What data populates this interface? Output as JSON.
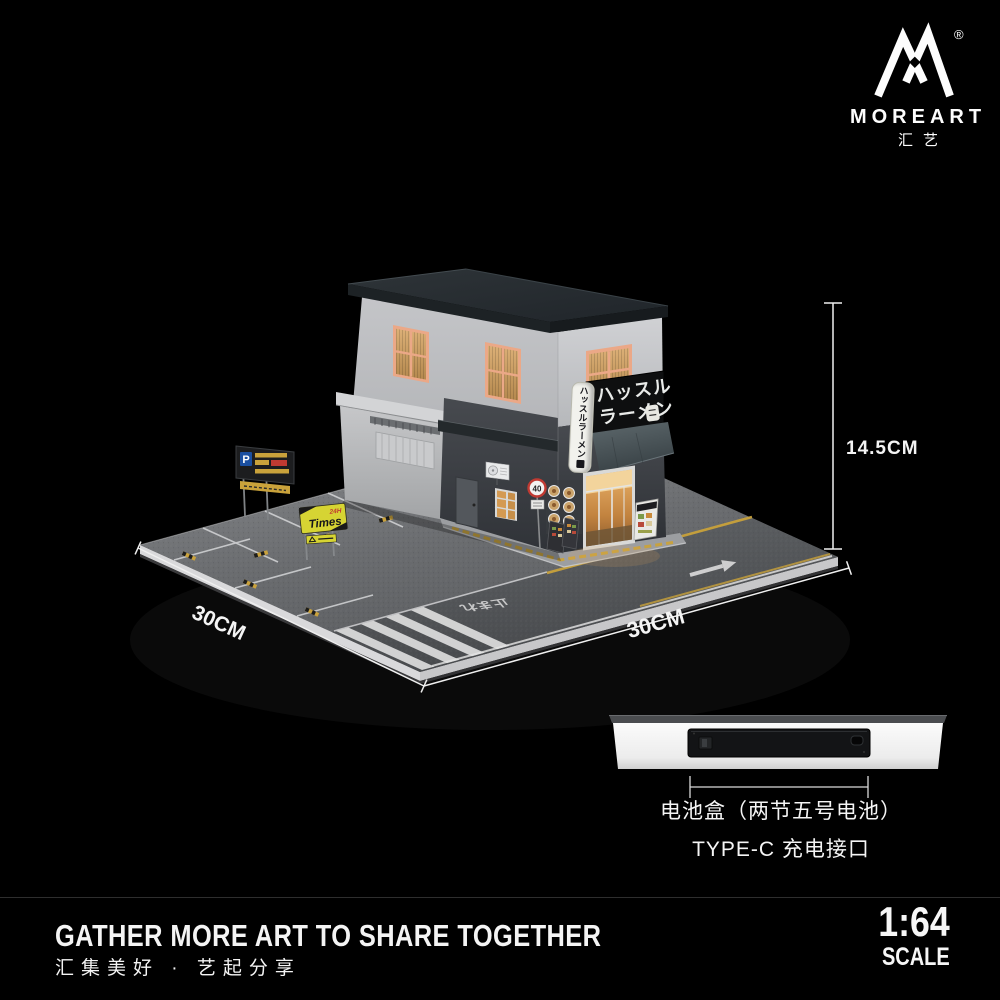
{
  "page": {
    "background": "#000000"
  },
  "brand": {
    "name": "MOREART",
    "name_cn": "汇艺",
    "registered": "®"
  },
  "scene": {
    "shop": {
      "main_sign": {
        "line1": "ハッスル",
        "line2": "ラーメン"
      },
      "vertical_sign": "ハッスルラーメン",
      "speed_limit_sign": "40",
      "road_marking_text": "止まれ"
    },
    "parking": {
      "lot_sign_symbol": "P",
      "times_sign": {
        "hours": "24H",
        "name": "Times"
      }
    }
  },
  "dimensions": {
    "height_label": "14.5CM",
    "depth_label": "30CM",
    "width_label": "30CM"
  },
  "battery_info": {
    "line1": "电池盒（两节五号电池）",
    "line2": "TYPE-C 充电接口"
  },
  "footer": {
    "slogan_en": "GATHER MORE ART TO SHARE TOGETHER",
    "slogan_cn": "汇集美好 · 艺起分享",
    "scale_value": "1:64",
    "scale_word": "SCALE"
  },
  "colors": {
    "accent_yellow": "#c9a23b",
    "window_glow": "#d8a060",
    "sign_black": "#0e0f10",
    "asphalt_gray": "#66686b"
  }
}
